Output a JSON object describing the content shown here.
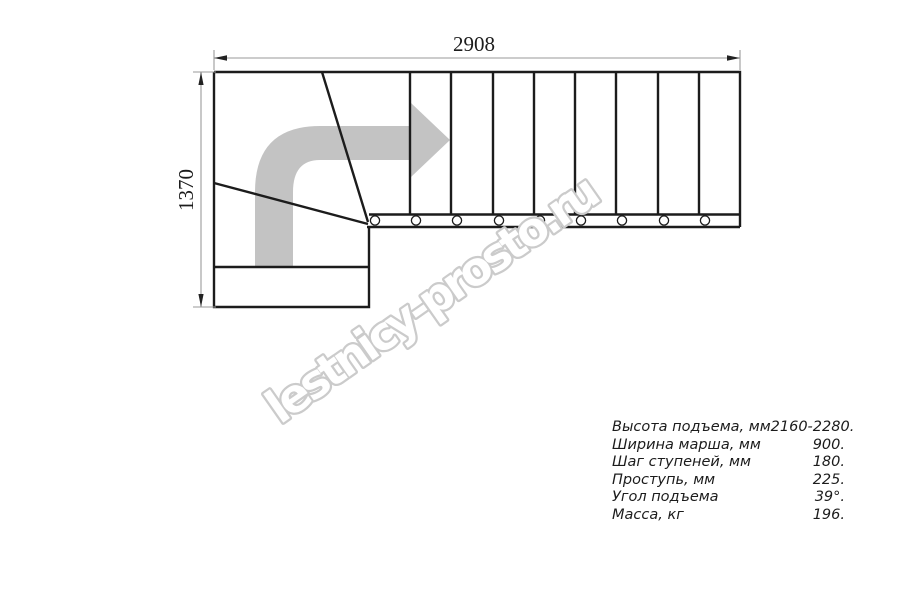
{
  "drawing": {
    "title": "stair-plan-top-view",
    "dimensions": {
      "width_label": "2908",
      "height_label": "1370"
    },
    "straight_tread_count": 9,
    "baluster_count": 9
  },
  "watermark": {
    "text": "lestnicy-prosto.ru"
  },
  "specs": {
    "rows": [
      {
        "label": "Высота подъема, мм",
        "value": "2160-2280."
      },
      {
        "label": "Ширина марша, мм",
        "value": "900."
      },
      {
        "label": "Шаг ступеней, мм",
        "value": "180."
      },
      {
        "label": "Проступь, мм",
        "value": "225."
      },
      {
        "label": "Угол подъема",
        "value": "39°."
      },
      {
        "label": "Масса, кг",
        "value": "196."
      }
    ]
  },
  "colors": {
    "line": "#1c1c1c",
    "dim-line": "#9a9a9a",
    "dim-arrow": "#222222",
    "ink": "#1c1c1c",
    "flow-arrow": "#c3c3c3",
    "watermark": "#cbcbcb",
    "background": "#ffffff"
  }
}
